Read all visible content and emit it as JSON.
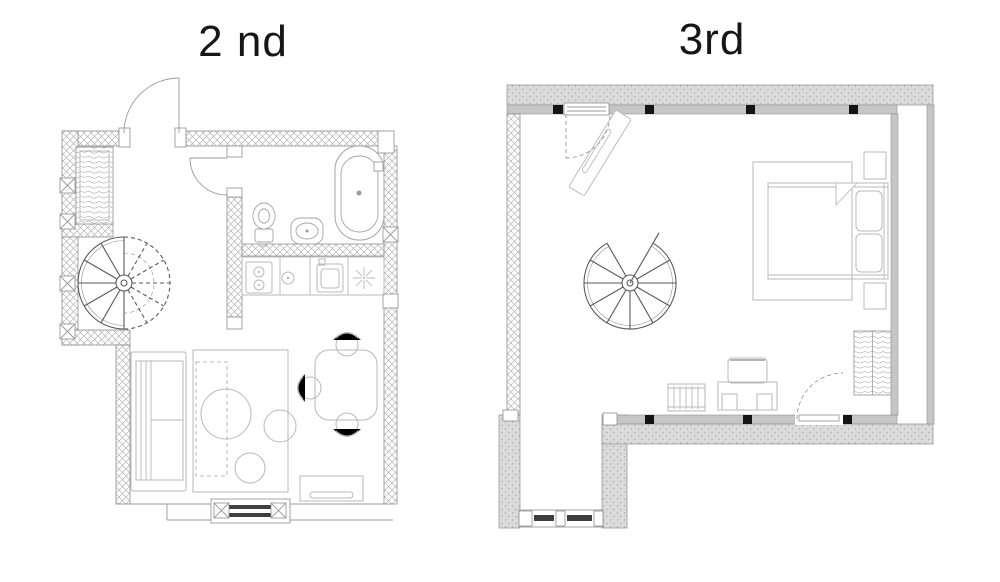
{
  "page": {
    "type": "floor-plan-sheet",
    "background": "#ffffff"
  },
  "colors": {
    "wall_hatch": "#b5b5b5",
    "wall_outline": "#8f8f8f",
    "thick_wall_fill": "#dcdcdc",
    "thin_wall_fill": "#c6c6c6",
    "furniture_line": "#b9b9b9",
    "fixture_line": "#a5a5a5",
    "stair_line": "#5a5a5a",
    "glazing_dark": "#3f3f3f",
    "column_marker": "#141414",
    "title_text": "#161616"
  },
  "floors": {
    "second": {
      "title": "2 nd",
      "label": "second-floor-plan",
      "features": [
        "entry-door-swing",
        "wardrobe",
        "column-x-markers",
        "spiral-staircase-half-dashed",
        "bathroom",
        "bathtub",
        "toilet",
        "washbasin",
        "interior-door-swing",
        "kitchen-counter",
        "two-burner-stove",
        "aux-burner",
        "kitchen-sink",
        "fan-symbol",
        "sofa",
        "area-rug",
        "round-coffee-tables",
        "dining-table",
        "dining-chairs",
        "tv-cabinet",
        "glazed-window-bay"
      ]
    },
    "third": {
      "title": "3rd",
      "label": "third-floor-plan",
      "features": [
        "roof-window-skylight",
        "window-swing-arc",
        "column-markers",
        "spiral-staircase",
        "area-rug",
        "double-bed",
        "pillows",
        "blanket-fold",
        "nightstands",
        "wardrobe",
        "desk",
        "desk-chair",
        "radiator",
        "door-swing",
        "dormer-recess",
        "dormer-glazed-window"
      ]
    }
  }
}
